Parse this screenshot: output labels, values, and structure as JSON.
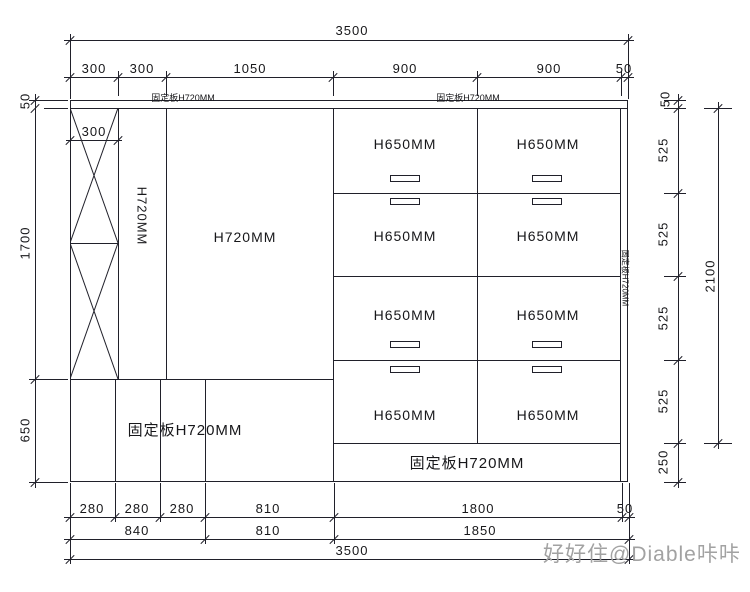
{
  "drawing": {
    "type": "cabinet-elevation",
    "dims": {
      "top_total": "3500",
      "top_segments": [
        "300",
        "300",
        "1050",
        "900",
        "900",
        "50"
      ],
      "inner_width": "300",
      "left": [
        "50",
        "1700",
        "650"
      ],
      "right_segments": [
        "50",
        "525",
        "525",
        "525",
        "525",
        "250"
      ],
      "right_total": "2100",
      "bottom_row1": [
        "280",
        "280",
        "280",
        "810",
        "1800",
        "50"
      ],
      "bottom_row2": [
        "840",
        "810",
        "1850"
      ],
      "bottom_total": "3500"
    },
    "labels": {
      "top_panel_left": "固定板H720MM",
      "top_panel_right": "固定板H720MM",
      "tall_column": "H720MM",
      "open_area": "H720MM",
      "bottom_left_panel": "固定板H720MM",
      "bottom_right_panel": "固定板H720MM",
      "right_side_panel": "固定板H720MM",
      "drawer": "H650MM"
    },
    "watermark": "好好住@Diable咔咔",
    "colors": {
      "line": "#20202a",
      "watermark": "#a2a2a2",
      "background": "#ffffff"
    }
  }
}
